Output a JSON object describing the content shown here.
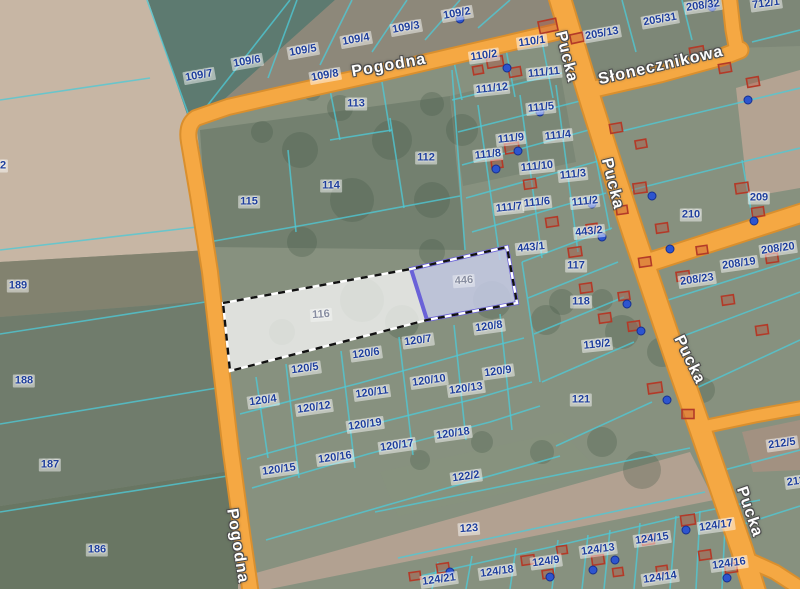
{
  "map": {
    "title": "cadastral parcel map with aerial imagery",
    "colors": {
      "road": "#f5a843",
      "road_casing": "#d98f2e",
      "parcel_line": "#4ec9d6",
      "parcel_label": "#1e3e9c",
      "street_label": "#ffffff",
      "building_outline": "#b33a28",
      "address_point": "#2d55cf",
      "selection_border": "#6a62d8",
      "selection_fill_white": "rgba(252,252,252,0.74)",
      "selection_fill_purple": "rgba(203,207,238,0.8)"
    },
    "selection": {
      "main_parcel": "116",
      "sub_parcel": "446",
      "style": "black-white dashed boundary with purple sub-parcel"
    },
    "streets": [
      {
        "name": "Pogodna",
        "x": 389,
        "y": 66,
        "rot": -10
      },
      {
        "name": "Słonecznikowa",
        "x": 661,
        "y": 66,
        "rot": -13
      },
      {
        "name": "Pucka",
        "x": 566,
        "y": 57,
        "rot": 76
      },
      {
        "name": "Pucka",
        "x": 612,
        "y": 184,
        "rot": 76
      },
      {
        "name": "Pucka",
        "x": 689,
        "y": 360,
        "rot": 64
      },
      {
        "name": "Pucka",
        "x": 749,
        "y": 512,
        "rot": 71
      },
      {
        "name": "Pogodna",
        "x": 237,
        "y": 546,
        "rot": 81
      }
    ],
    "parcels": [
      {
        "id": "109/7",
        "x": 199,
        "y": 76,
        "rot": -10
      },
      {
        "id": "109/6",
        "x": 247,
        "y": 62,
        "rot": -10
      },
      {
        "id": "109/5",
        "x": 303,
        "y": 51,
        "rot": -10
      },
      {
        "id": "109/4",
        "x": 356,
        "y": 40,
        "rot": -10
      },
      {
        "id": "109/3",
        "x": 406,
        "y": 28,
        "rot": -10
      },
      {
        "id": "109/2",
        "x": 457,
        "y": 14,
        "rot": -10
      },
      {
        "id": "109/8",
        "x": 325,
        "y": 76,
        "rot": -10
      },
      {
        "id": "113",
        "x": 356,
        "y": 104,
        "rot": 0
      },
      {
        "id": "112",
        "x": 426,
        "y": 158,
        "rot": 0
      },
      {
        "id": "114",
        "x": 331,
        "y": 186,
        "rot": 0
      },
      {
        "id": "115",
        "x": 249,
        "y": 202,
        "rot": 0
      },
      {
        "id": "2",
        "x": 3,
        "y": 166,
        "rot": 0
      },
      {
        "id": "189",
        "x": 18,
        "y": 286,
        "rot": 0
      },
      {
        "id": "188",
        "x": 24,
        "y": 381,
        "rot": 0
      },
      {
        "id": "187",
        "x": 50,
        "y": 465,
        "rot": 0
      },
      {
        "id": "186",
        "x": 97,
        "y": 550,
        "rot": 0
      },
      {
        "id": "110/2",
        "x": 484,
        "y": 56,
        "rot": -8
      },
      {
        "id": "110/1",
        "x": 532,
        "y": 42,
        "rot": -8
      },
      {
        "id": "111/12",
        "x": 492,
        "y": 89,
        "rot": -6
      },
      {
        "id": "111/11",
        "x": 544,
        "y": 73,
        "rot": -6
      },
      {
        "id": "111/5",
        "x": 541,
        "y": 108,
        "rot": -6
      },
      {
        "id": "111/9",
        "x": 511,
        "y": 139,
        "rot": -6
      },
      {
        "id": "111/4",
        "x": 558,
        "y": 136,
        "rot": -6
      },
      {
        "id": "111/8",
        "x": 488,
        "y": 155,
        "rot": -6
      },
      {
        "id": "111/10",
        "x": 537,
        "y": 167,
        "rot": -6
      },
      {
        "id": "111/3",
        "x": 573,
        "y": 175,
        "rot": -6
      },
      {
        "id": "111/7",
        "x": 509,
        "y": 208,
        "rot": -6
      },
      {
        "id": "111/6",
        "x": 537,
        "y": 203,
        "rot": -6
      },
      {
        "id": "111/2",
        "x": 585,
        "y": 202,
        "rot": -6
      },
      {
        "id": "443/2",
        "x": 589,
        "y": 232,
        "rot": -6
      },
      {
        "id": "443/1",
        "x": 531,
        "y": 248,
        "rot": -6
      },
      {
        "id": "117",
        "x": 576,
        "y": 266,
        "rot": 0
      },
      {
        "id": "118",
        "x": 581,
        "y": 302,
        "rot": 0
      },
      {
        "id": "119/2",
        "x": 597,
        "y": 345,
        "rot": -6
      },
      {
        "id": "121",
        "x": 581,
        "y": 400,
        "rot": 0
      },
      {
        "id": "205/13",
        "x": 602,
        "y": 34,
        "rot": -10
      },
      {
        "id": "205/31",
        "x": 660,
        "y": 20,
        "rot": -10
      },
      {
        "id": "208/32",
        "x": 703,
        "y": 6,
        "rot": -8
      },
      {
        "id": "712/1",
        "x": 766,
        "y": 4,
        "rot": -8
      },
      {
        "id": "209",
        "x": 759,
        "y": 198,
        "rot": 0
      },
      {
        "id": "210",
        "x": 691,
        "y": 215,
        "rot": 0
      },
      {
        "id": "208/20",
        "x": 778,
        "y": 249,
        "rot": -8
      },
      {
        "id": "208/19",
        "x": 739,
        "y": 264,
        "rot": -8
      },
      {
        "id": "208/23",
        "x": 697,
        "y": 280,
        "rot": -8
      },
      {
        "id": "212/5",
        "x": 782,
        "y": 444,
        "rot": -8
      },
      {
        "id": "213",
        "x": 796,
        "y": 482,
        "rot": -8
      },
      {
        "id": "116",
        "x": 321,
        "y": 315,
        "rot": -4,
        "dim": true
      },
      {
        "id": "446",
        "x": 464,
        "y": 281,
        "rot": -4,
        "dim": true
      },
      {
        "id": "120/8",
        "x": 489,
        "y": 327,
        "rot": -8
      },
      {
        "id": "120/7",
        "x": 418,
        "y": 341,
        "rot": -8
      },
      {
        "id": "120/6",
        "x": 366,
        "y": 354,
        "rot": -8
      },
      {
        "id": "120/5",
        "x": 305,
        "y": 369,
        "rot": -8
      },
      {
        "id": "120/4",
        "x": 263,
        "y": 401,
        "rot": -8
      },
      {
        "id": "120/12",
        "x": 314,
        "y": 408,
        "rot": -8
      },
      {
        "id": "120/11",
        "x": 372,
        "y": 393,
        "rot": -8
      },
      {
        "id": "120/10",
        "x": 429,
        "y": 381,
        "rot": -8
      },
      {
        "id": "120/13",
        "x": 466,
        "y": 389,
        "rot": -8
      },
      {
        "id": "120/9",
        "x": 498,
        "y": 372,
        "rot": -8
      },
      {
        "id": "120/19",
        "x": 365,
        "y": 425,
        "rot": -8
      },
      {
        "id": "120/18",
        "x": 453,
        "y": 434,
        "rot": -8
      },
      {
        "id": "120/17",
        "x": 397,
        "y": 446,
        "rot": -8
      },
      {
        "id": "120/16",
        "x": 335,
        "y": 458,
        "rot": -8
      },
      {
        "id": "120/15",
        "x": 279,
        "y": 470,
        "rot": -8
      },
      {
        "id": "122/2",
        "x": 466,
        "y": 477,
        "rot": -8
      },
      {
        "id": "123",
        "x": 469,
        "y": 529,
        "rot": -4
      },
      {
        "id": "124/21",
        "x": 439,
        "y": 580,
        "rot": -8
      },
      {
        "id": "124/18",
        "x": 497,
        "y": 572,
        "rot": -8
      },
      {
        "id": "124/9",
        "x": 546,
        "y": 562,
        "rot": -8
      },
      {
        "id": "124/13",
        "x": 598,
        "y": 550,
        "rot": -8
      },
      {
        "id": "124/15",
        "x": 652,
        "y": 539,
        "rot": -8
      },
      {
        "id": "124/17",
        "x": 716,
        "y": 526,
        "rot": -8
      },
      {
        "id": "124/16",
        "x": 729,
        "y": 564,
        "rot": -8
      },
      {
        "id": "124/14",
        "x": 660,
        "y": 578,
        "rot": -8
      }
    ]
  }
}
